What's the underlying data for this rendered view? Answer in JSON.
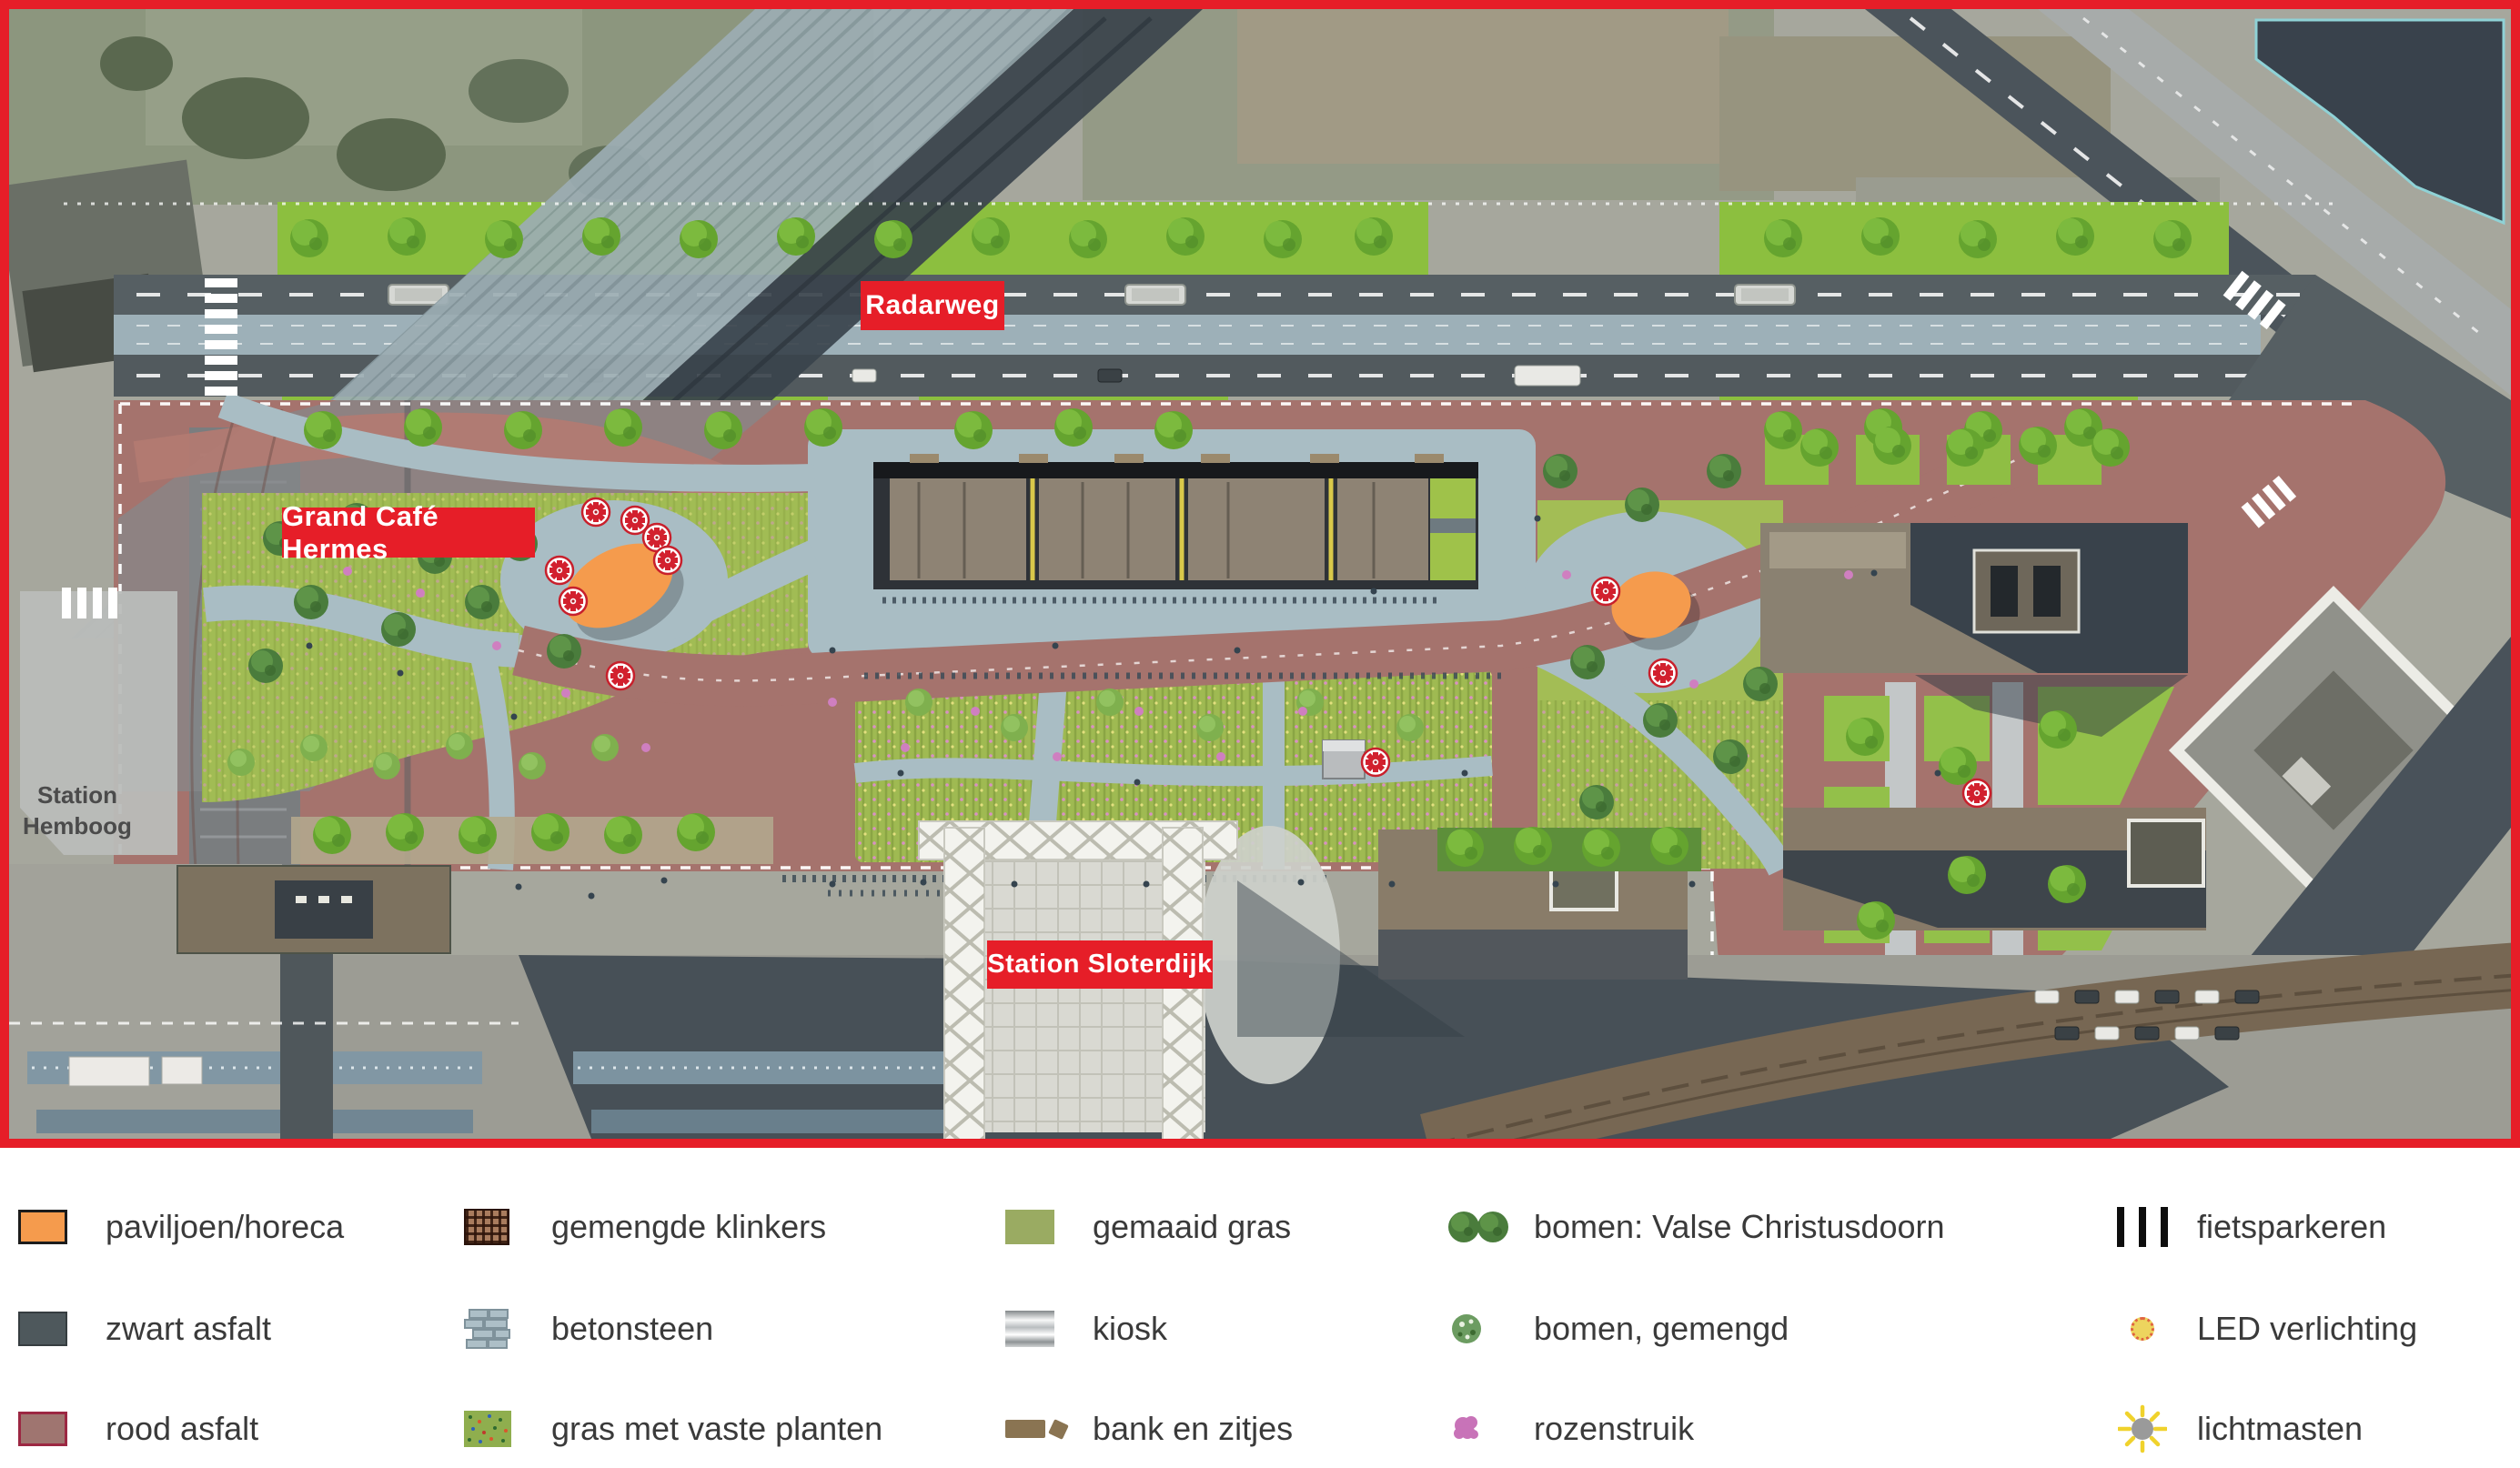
{
  "map": {
    "labels": {
      "radarweg": "Radarweg",
      "grand_cafe": "Grand Café Hermes",
      "station_sloterdijk": "Station Sloterdijk",
      "station_hemboog_line1": "Station",
      "station_hemboog_line2": "Hemboog"
    },
    "label_color": "#e61e28",
    "frame_color": "#e61e28"
  },
  "legend": {
    "items": [
      {
        "icon": "pavilion-swatch",
        "label": "paviljoen/horeca",
        "color": "#f59b4d"
      },
      {
        "icon": "black-asphalt-swatch",
        "label": "zwart asfalt",
        "color": "#4e585c"
      },
      {
        "icon": "red-asphalt-swatch",
        "label": "rood asfalt",
        "color": "#9f7570"
      },
      {
        "icon": "mixed-clinkers-swatch",
        "label": "gemengde klinkers",
        "color": "#a97c5e"
      },
      {
        "icon": "concrete-stone-swatch",
        "label": "betonsteen",
        "color": "#adbfc7"
      },
      {
        "icon": "grass-perennials-swatch",
        "label": "gras met vaste planten",
        "color": "#8fae4e"
      },
      {
        "icon": "mown-grass-swatch",
        "label": "gemaaid gras",
        "color": "#9aab62"
      },
      {
        "icon": "kiosk-swatch",
        "label": "kiosk",
        "color": "#c7cbcd"
      },
      {
        "icon": "bench-seating-swatch",
        "label": "bank en zitjes",
        "color": "#8a7452"
      },
      {
        "icon": "trees-christusdoorn-icon",
        "label": "bomen: Valse Christusdoorn",
        "color": "#4a7c3c"
      },
      {
        "icon": "trees-mixed-icon",
        "label": "bomen, gemengd",
        "color": "#5c9150"
      },
      {
        "icon": "rose-bush-icon",
        "label": "rozenstruik",
        "color": "#c873b8"
      },
      {
        "icon": "bike-parking-icon",
        "label": "fietsparkeren",
        "color": "#0d0d0d"
      },
      {
        "icon": "led-lighting-icon",
        "label": "LED verlichting",
        "color": "#edd45e"
      },
      {
        "icon": "light-mast-icon",
        "label": "lichtmasten",
        "color": "#9a9a9a"
      }
    ]
  }
}
